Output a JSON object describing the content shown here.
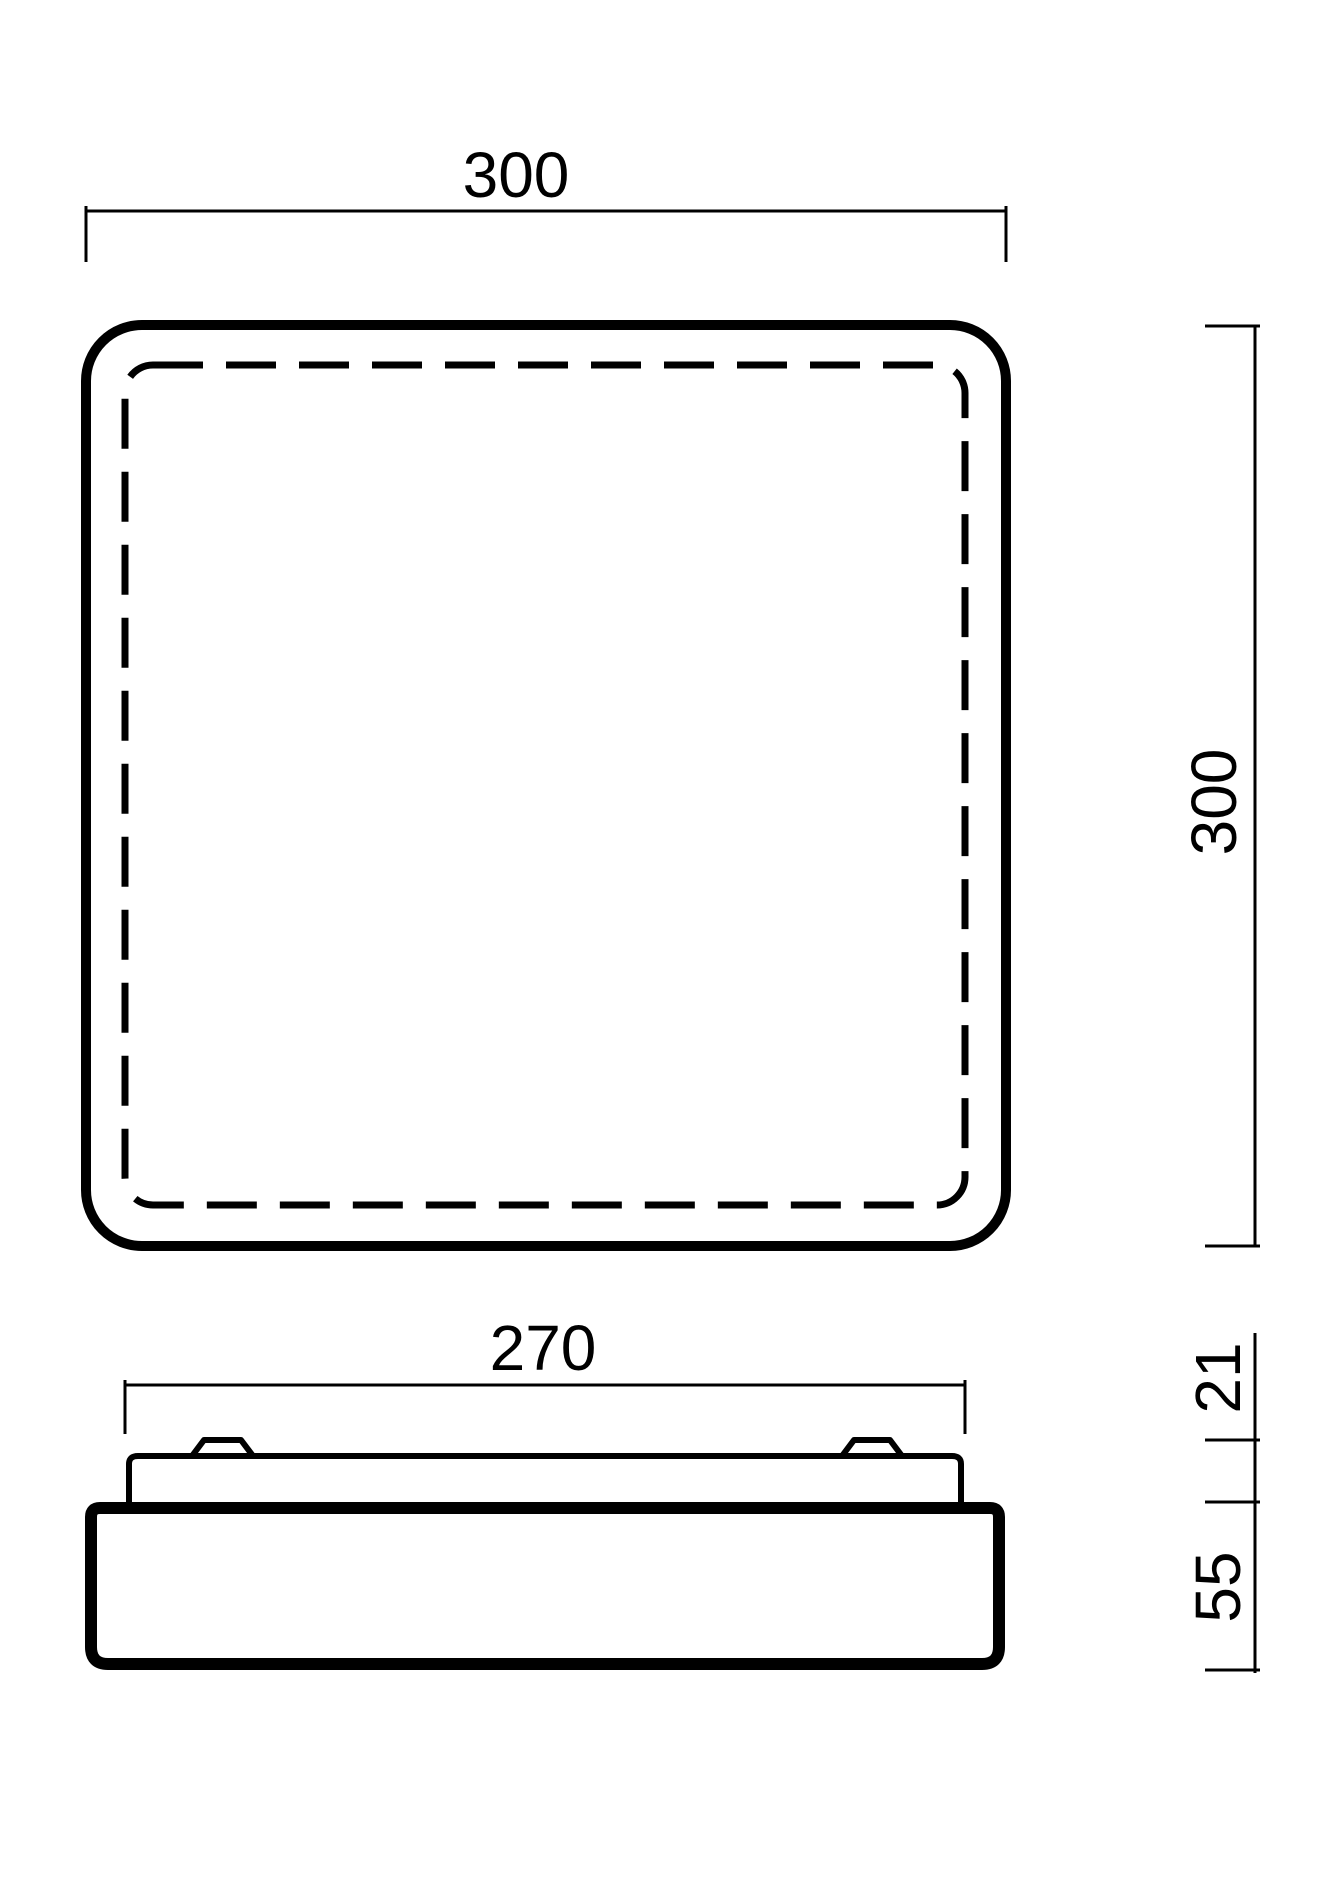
{
  "colors": {
    "background": "#ffffff",
    "line": "#000000"
  },
  "dimensions": {
    "plan_width": "300",
    "plan_height": "300",
    "mounting_plate_width": "270",
    "mounting_plate_height": "21",
    "diffuser_body_height": "55"
  }
}
